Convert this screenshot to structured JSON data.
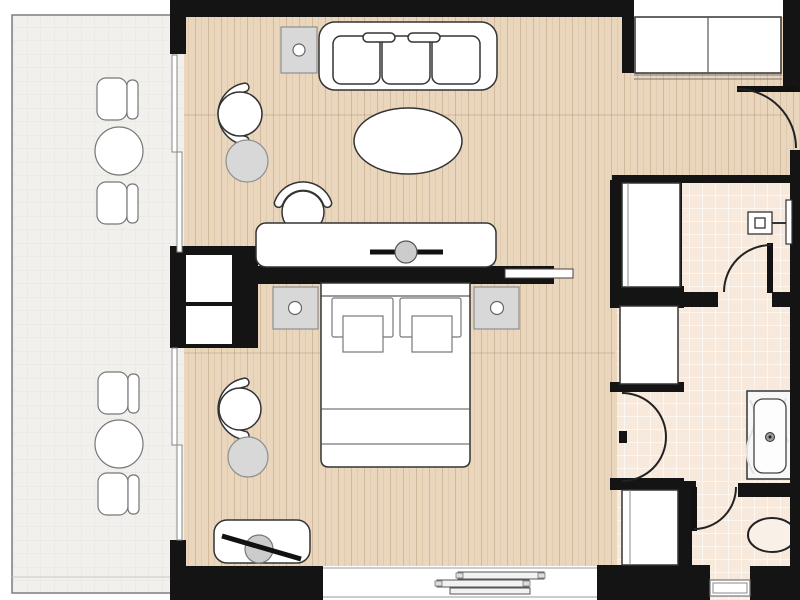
{
  "plan": {
    "kind": "hotel-suite-floor-plan",
    "palette_note": "colors sampled from drawing"
  },
  "palette": {
    "wall_color": "#141414",
    "wood_floor": "#e9d6bd",
    "tile_floor": "#f7e9db",
    "balcony_floor": "#f1f0ed",
    "outline_color": "#333333",
    "gray_fill": "#d8d8d8",
    "glass_color": "#ffffff"
  },
  "rooms": {
    "balcony": {
      "floor": "outdoor-tile",
      "furniture": [
        "outdoor-chair",
        "outdoor-table",
        "outdoor-chair",
        "outdoor-chair",
        "outdoor-table",
        "outdoor-chair"
      ],
      "openings": [
        "sliding-glass-door",
        "sliding-glass-door"
      ]
    },
    "living_area": {
      "floor": "wood-plank",
      "furniture": [
        "three-seat-sofa",
        "throw-pillow",
        "throw-pillow",
        "side-table-with-lamp",
        "oval-coffee-table",
        "armchair",
        "round-side-table",
        "console-desk",
        "desk-chair",
        "tv-on-console"
      ]
    },
    "bedroom": {
      "floor": "wood-plank",
      "furniture": [
        "double-bed",
        "pillow",
        "pillow",
        "nightstand-with-lamp",
        "nightstand-with-lamp",
        "armchair",
        "round-side-table",
        "tv-bench",
        "service-unit-niches"
      ],
      "openings": [
        "partition-wall",
        "pocket-sliding-door",
        "window-with-louvers"
      ]
    },
    "entry_hall": {
      "floor": "wood-plank",
      "furniture": [
        "sliding-door-wardrobe"
      ],
      "openings": [
        "entry-door"
      ]
    },
    "shower_room": {
      "floor": "ceramic-tile",
      "fixtures": [
        "shower-fixture",
        "wall-panel"
      ],
      "openings": [
        "swing-door"
      ]
    },
    "bathroom": {
      "floor": "ceramic-tile",
      "fixtures": [
        "bathtub",
        "toilet",
        "window-bench"
      ],
      "openings": [
        "swing-door"
      ]
    },
    "wardrobe_corridor": {
      "floor": "ceramic-tile",
      "furniture": [
        "closet",
        "closet",
        "closet"
      ],
      "openings": [
        "double-swing-doors"
      ]
    }
  }
}
